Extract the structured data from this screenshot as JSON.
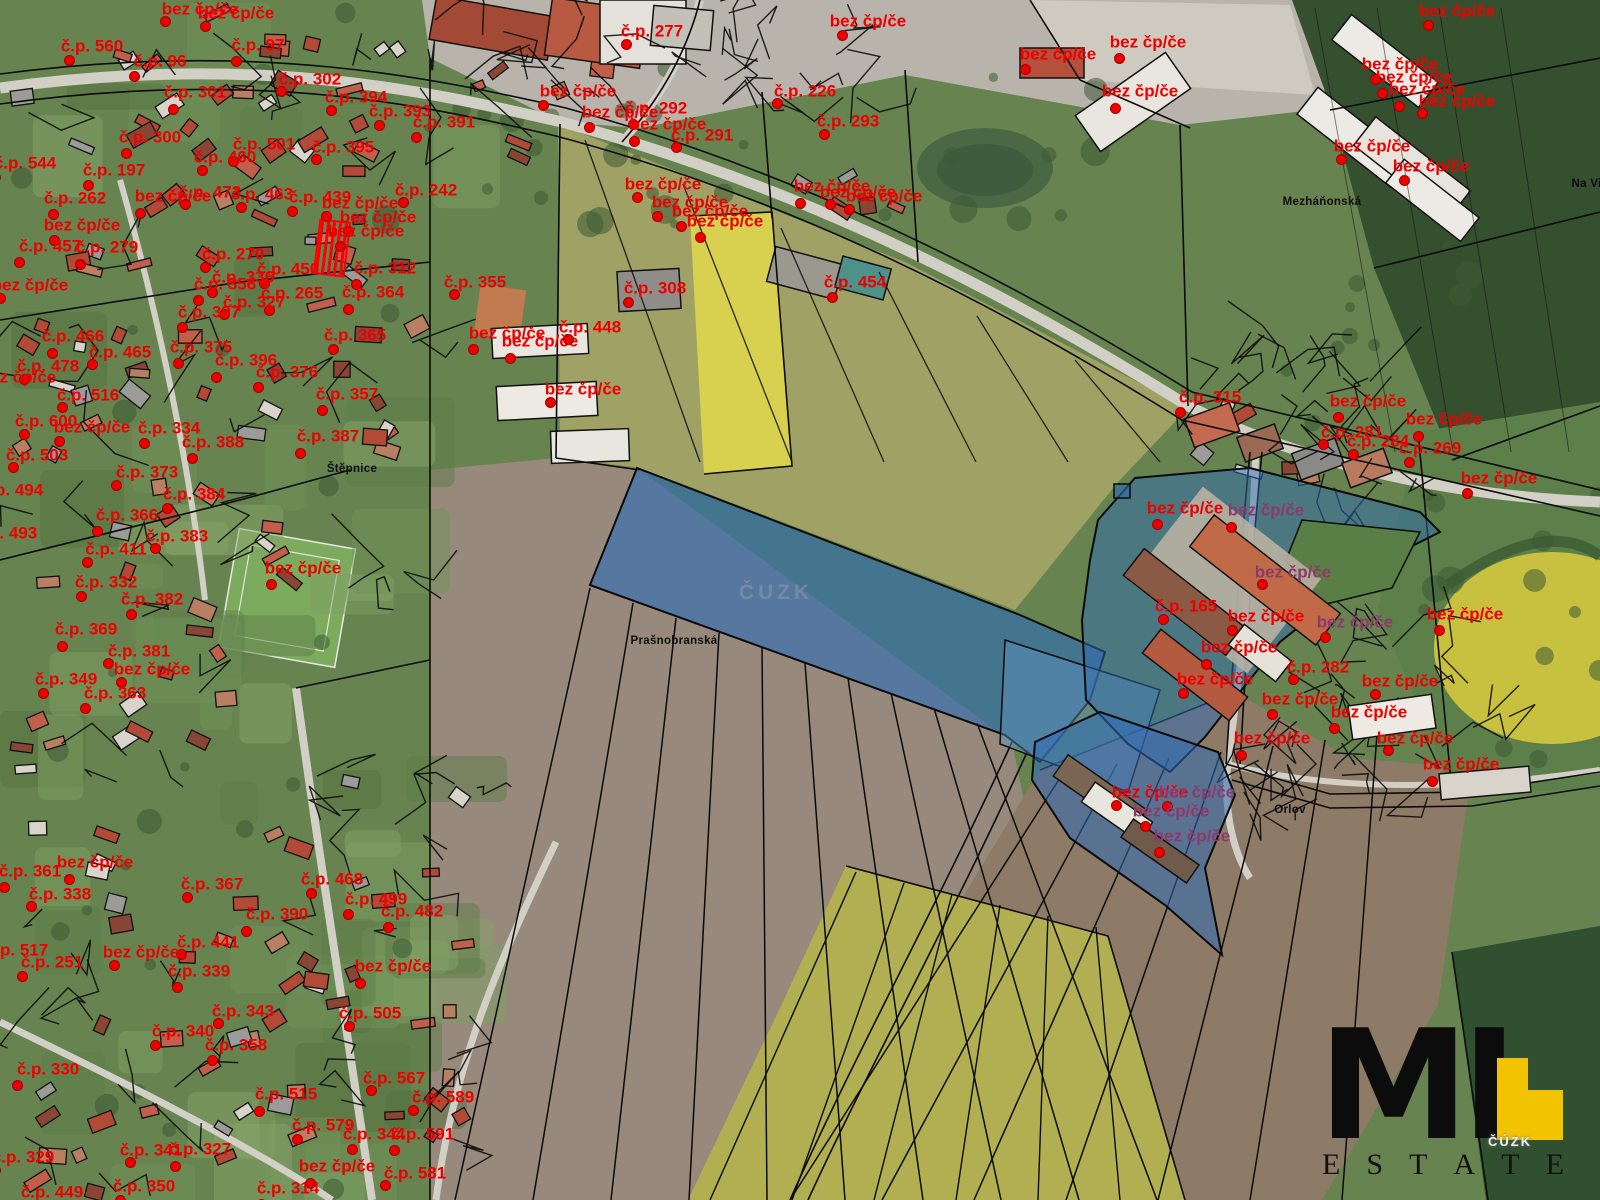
{
  "map": {
    "watermark_center": "ČUZK",
    "watermark_logo_area": "ČÚZK",
    "highlight_fill": "#2f6cb4",
    "label_colors": {
      "red": "#ee0000",
      "purple": "#8d3a6a",
      "black": "#0d0d0d"
    },
    "place_labels": [
      {
        "text": "Prašnobranská",
        "x": 674,
        "y": 641
      },
      {
        "text": "Štěpnice",
        "x": 352,
        "y": 469
      },
      {
        "text": "Mezháňonská",
        "x": 1322,
        "y": 202
      },
      {
        "text": "Orlov",
        "x": 1290,
        "y": 810
      },
      {
        "text": "Na Vinici",
        "x": 1597,
        "y": 184
      }
    ],
    "parcel_labels": [
      {
        "t": "bez čp/če",
        "x": 200,
        "y": 9
      },
      {
        "t": "bez čp/če",
        "x": 236,
        "y": 13
      },
      {
        "t": "č.p. 560",
        "x": 92,
        "y": 46
      },
      {
        "t": "č.p. 96",
        "x": 160,
        "y": 61
      },
      {
        "t": "č.p. 97",
        "x": 258,
        "y": 45
      },
      {
        "t": "č.p. 301",
        "x": 195,
        "y": 92
      },
      {
        "t": "č.p. 302",
        "x": 310,
        "y": 79
      },
      {
        "t": "č.p. 394",
        "x": 356,
        "y": 97
      },
      {
        "t": "č.p. 393",
        "x": 400,
        "y": 111
      },
      {
        "t": "č.p. 391",
        "x": 444,
        "y": 122
      },
      {
        "t": "č.p. 300",
        "x": 150,
        "y": 137
      },
      {
        "t": "č.p. 501",
        "x": 264,
        "y": 144
      },
      {
        "t": "č.p. 395",
        "x": 343,
        "y": 147
      },
      {
        "t": "č.p. 460",
        "x": 225,
        "y": 157
      },
      {
        "t": "č.p. 544",
        "x": 25,
        "y": 163
      },
      {
        "t": "č.p. 197",
        "x": 114,
        "y": 170
      },
      {
        "t": "č.p. 262",
        "x": 75,
        "y": 198
      },
      {
        "t": "bez čp/če",
        "x": 173,
        "y": 196
      },
      {
        "t": "č.p. 473",
        "x": 210,
        "y": 192
      },
      {
        "t": "č.p. 463",
        "x": 262,
        "y": 194
      },
      {
        "t": "č.p. 439",
        "x": 320,
        "y": 197
      },
      {
        "t": "bez čp/če",
        "x": 82,
        "y": 225
      },
      {
        "t": "č.p. 457",
        "x": 50,
        "y": 246
      },
      {
        "t": "č.p. 279",
        "x": 107,
        "y": 247
      },
      {
        "t": "č.p. 242",
        "x": 426,
        "y": 190
      },
      {
        "t": "bez čp/če",
        "x": 360,
        "y": 203
      },
      {
        "t": "bez čp/če",
        "x": 378,
        "y": 217
      },
      {
        "t": "bez čp/če",
        "x": 366,
        "y": 231
      },
      {
        "t": "č.p. 312",
        "x": 385,
        "y": 268
      },
      {
        "t": "č.p. 364",
        "x": 373,
        "y": 292
      },
      {
        "t": "č.p. 355",
        "x": 475,
        "y": 282
      },
      {
        "t": "č.p. 270",
        "x": 233,
        "y": 254
      },
      {
        "t": "č.p. 450",
        "x": 288,
        "y": 269
      },
      {
        "t": "č.p. 336",
        "x": 243,
        "y": 277
      },
      {
        "t": "č.p. 356",
        "x": 225,
        "y": 284
      },
      {
        "t": "č.p. 265",
        "x": 292,
        "y": 293
      },
      {
        "t": "č.p. 327",
        "x": 254,
        "y": 302
      },
      {
        "t": "bez čp/če",
        "x": 30,
        "y": 285
      },
      {
        "t": "č.p. 365",
        "x": 355,
        "y": 335
      },
      {
        "t": "č.p. 376",
        "x": 287,
        "y": 372
      },
      {
        "t": "č.p. 357",
        "x": 347,
        "y": 394
      },
      {
        "t": "č.p. 466",
        "x": 73,
        "y": 336
      },
      {
        "t": "č.p. 465",
        "x": 120,
        "y": 352
      },
      {
        "t": "č.p. 478",
        "x": 48,
        "y": 366
      },
      {
        "t": "bez čp/če",
        "x": 18,
        "y": 377
      },
      {
        "t": "č.p. 397",
        "x": 209,
        "y": 312
      },
      {
        "t": "č.p. 375",
        "x": 201,
        "y": 347
      },
      {
        "t": "č.p. 396",
        "x": 246,
        "y": 360
      },
      {
        "t": "č.p. 516",
        "x": 88,
        "y": 395
      },
      {
        "t": "č.p. 600",
        "x": 46,
        "y": 421
      },
      {
        "t": "bez čp/če",
        "x": 92,
        "y": 427
      },
      {
        "t": "č.p. 334",
        "x": 169,
        "y": 428
      },
      {
        "t": "č.p. 388",
        "x": 213,
        "y": 442
      },
      {
        "t": "č.p. 387",
        "x": 328,
        "y": 436
      },
      {
        "t": "č.p. 503",
        "x": 37,
        "y": 455
      },
      {
        "t": "č.p. 373",
        "x": 147,
        "y": 472
      },
      {
        "t": "č.p. 384",
        "x": 194,
        "y": 494
      },
      {
        "t": "č.p. 494",
        "x": 12,
        "y": 490
      },
      {
        "t": "č.p. 366",
        "x": 127,
        "y": 515
      },
      {
        "t": "č.p. 493",
        "x": 6,
        "y": 533
      },
      {
        "t": "č.p. 383",
        "x": 177,
        "y": 536
      },
      {
        "t": "č.p. 411",
        "x": 116,
        "y": 549
      },
      {
        "t": "č.p. 332",
        "x": 106,
        "y": 582
      },
      {
        "t": "č.p. 382",
        "x": 152,
        "y": 599
      },
      {
        "t": "bez čp/če",
        "x": 303,
        "y": 568
      },
      {
        "t": "č.p. 369",
        "x": 86,
        "y": 629
      },
      {
        "t": "č.p. 381",
        "x": 139,
        "y": 651
      },
      {
        "t": "bez čp/če",
        "x": 152,
        "y": 669
      },
      {
        "t": "č.p. 349",
        "x": 66,
        "y": 679
      },
      {
        "t": "č.p. 363",
        "x": 115,
        "y": 693
      },
      {
        "t": "č.p. 361",
        "x": 30,
        "y": 871
      },
      {
        "t": "bez čp/če",
        "x": 95,
        "y": 862
      },
      {
        "t": "č.p. 338",
        "x": 60,
        "y": 894
      },
      {
        "t": "č.p. 367",
        "x": 212,
        "y": 884
      },
      {
        "t": "č.p. 468",
        "x": 332,
        "y": 879
      },
      {
        "t": "č.p. 499",
        "x": 376,
        "y": 899
      },
      {
        "t": "č.p. 482",
        "x": 412,
        "y": 911
      },
      {
        "t": "č.p. 390",
        "x": 277,
        "y": 914
      },
      {
        "t": "č.p. 441",
        "x": 208,
        "y": 942
      },
      {
        "t": "bez čp/če",
        "x": 141,
        "y": 952
      },
      {
        "t": "č.p. 251",
        "x": 52,
        "y": 962
      },
      {
        "t": "č.p. 517",
        "x": 17,
        "y": 950
      },
      {
        "t": "č.p. 339",
        "x": 199,
        "y": 971
      },
      {
        "t": "bez čp/če",
        "x": 393,
        "y": 966
      },
      {
        "t": "č.p. 343",
        "x": 243,
        "y": 1011
      },
      {
        "t": "č.p. 505",
        "x": 370,
        "y": 1013
      },
      {
        "t": "č.p. 340",
        "x": 183,
        "y": 1031
      },
      {
        "t": "č.p. 358",
        "x": 236,
        "y": 1045
      },
      {
        "t": "č.p. 330",
        "x": 48,
        "y": 1069
      },
      {
        "t": "č.p. 515",
        "x": 286,
        "y": 1094
      },
      {
        "t": "č.p. 567",
        "x": 394,
        "y": 1078
      },
      {
        "t": "č.p. 589",
        "x": 443,
        "y": 1097
      },
      {
        "t": "č.p. 579",
        "x": 323,
        "y": 1125
      },
      {
        "t": "č.p. 344",
        "x": 374,
        "y": 1134
      },
      {
        "t": "č.p. 591",
        "x": 423,
        "y": 1134
      },
      {
        "t": "č.p. 327",
        "x": 200,
        "y": 1149
      },
      {
        "t": "č.p. 341",
        "x": 151,
        "y": 1150
      },
      {
        "t": "č.p. 329",
        "x": 23,
        "y": 1157
      },
      {
        "t": "č.p. 350",
        "x": 144,
        "y": 1186
      },
      {
        "t": "č.p. 449",
        "x": 52,
        "y": 1192
      },
      {
        "t": "č.p. 314",
        "x": 288,
        "y": 1188
      },
      {
        "t": "bez čp/če",
        "x": 337,
        "y": 1166
      },
      {
        "t": "č.p. 581",
        "x": 415,
        "y": 1173
      },
      {
        "t": "č.p. 277",
        "x": 652,
        "y": 31
      },
      {
        "t": "bez čp/če",
        "x": 868,
        "y": 21
      },
      {
        "t": "bez čp/če",
        "x": 1058,
        "y": 54
      },
      {
        "t": "bez čp/če",
        "x": 1148,
        "y": 42
      },
      {
        "t": "bez čp/če",
        "x": 1140,
        "y": 91
      },
      {
        "t": "č.p. 226",
        "x": 805,
        "y": 91
      },
      {
        "t": "č.p. 293",
        "x": 848,
        "y": 121
      },
      {
        "t": "bez čp/če",
        "x": 578,
        "y": 91
      },
      {
        "t": "bez čp/če",
        "x": 620,
        "y": 112
      },
      {
        "t": "č.p. 292",
        "x": 656,
        "y": 108
      },
      {
        "t": "bez čp/če",
        "x": 668,
        "y": 124
      },
      {
        "t": "č.p. 291",
        "x": 702,
        "y": 135
      },
      {
        "t": "bez čp/če",
        "x": 663,
        "y": 184
      },
      {
        "t": "bez čp/če",
        "x": 690,
        "y": 202
      },
      {
        "t": "bez čp/če",
        "x": 710,
        "y": 211
      },
      {
        "t": "bez čp/če",
        "x": 725,
        "y": 221
      },
      {
        "t": "bez čp/če",
        "x": 832,
        "y": 186
      },
      {
        "t": "bez čp/če",
        "x": 858,
        "y": 192
      },
      {
        "t": "bez čp/če",
        "x": 884,
        "y": 196
      },
      {
        "t": "č.p. 308",
        "x": 655,
        "y": 288
      },
      {
        "t": "č.p. 454",
        "x": 855,
        "y": 282
      },
      {
        "t": "bez čp/če",
        "x": 507,
        "y": 333
      },
      {
        "t": "bez čp/če",
        "x": 540,
        "y": 341
      },
      {
        "t": "č.p. 448",
        "x": 590,
        "y": 327
      },
      {
        "t": "bez čp/če",
        "x": 583,
        "y": 389
      },
      {
        "t": "bez čp/če",
        "x": 1457,
        "y": 11
      },
      {
        "t": "bez čp/če",
        "x": 1400,
        "y": 64
      },
      {
        "t": "bez čp/če",
        "x": 1414,
        "y": 77
      },
      {
        "t": "bez čp/če",
        "x": 1427,
        "y": 89
      },
      {
        "t": "bez čp/če",
        "x": 1457,
        "y": 101
      },
      {
        "t": "bez čp/če",
        "x": 1372,
        "y": 146
      },
      {
        "t": "bez čp/če",
        "x": 1431,
        "y": 166
      },
      {
        "t": "č.p. 315",
        "x": 1210,
        "y": 397
      },
      {
        "t": "bez čp/če",
        "x": 1368,
        "y": 401
      },
      {
        "t": "bez čp/če",
        "x": 1444,
        "y": 419
      },
      {
        "t": "č.p. 281",
        "x": 1352,
        "y": 432
      },
      {
        "t": "č.p. 284",
        "x": 1378,
        "y": 441
      },
      {
        "t": "č.p. 269",
        "x": 1430,
        "y": 448
      },
      {
        "t": "bez čp/če",
        "x": 1499,
        "y": 478
      },
      {
        "t": "bez čp/če",
        "x": 1185,
        "y": 508
      },
      {
        "t": "bez čp/če",
        "x": 1266,
        "y": 510,
        "v": "p"
      },
      {
        "t": "bez čp/če",
        "x": 1293,
        "y": 572,
        "v": "p"
      },
      {
        "t": "č.p. 165",
        "x": 1186,
        "y": 606
      },
      {
        "t": "bez čp/če",
        "x": 1266,
        "y": 616
      },
      {
        "t": "bez čp/če",
        "x": 1355,
        "y": 622,
        "v": "p"
      },
      {
        "t": "bez čp/če",
        "x": 1465,
        "y": 614
      },
      {
        "t": "bez čp/če",
        "x": 1239,
        "y": 647
      },
      {
        "t": "č.p. 282",
        "x": 1318,
        "y": 667
      },
      {
        "t": "bez čp/če",
        "x": 1400,
        "y": 681
      },
      {
        "t": "bez čp/če",
        "x": 1215,
        "y": 679
      },
      {
        "t": "bez čp/če",
        "x": 1300,
        "y": 699
      },
      {
        "t": "bez čp/če",
        "x": 1369,
        "y": 712
      },
      {
        "t": "bez čp/če",
        "x": 1272,
        "y": 738
      },
      {
        "t": "bez čp/če",
        "x": 1415,
        "y": 738
      },
      {
        "t": "bez čp/če",
        "x": 1150,
        "y": 792
      },
      {
        "t": "bez čp/če",
        "x": 1197,
        "y": 792,
        "v": "p"
      },
      {
        "t": "bez čp/če",
        "x": 1171,
        "y": 811,
        "v": "p"
      },
      {
        "t": "bez čp/če",
        "x": 1192,
        "y": 836,
        "v": "p"
      },
      {
        "t": "bez čp/če",
        "x": 1461,
        "y": 764
      }
    ]
  },
  "logo": {
    "mark": "MI",
    "word": "ESTATE",
    "accent": "#f2c301"
  }
}
